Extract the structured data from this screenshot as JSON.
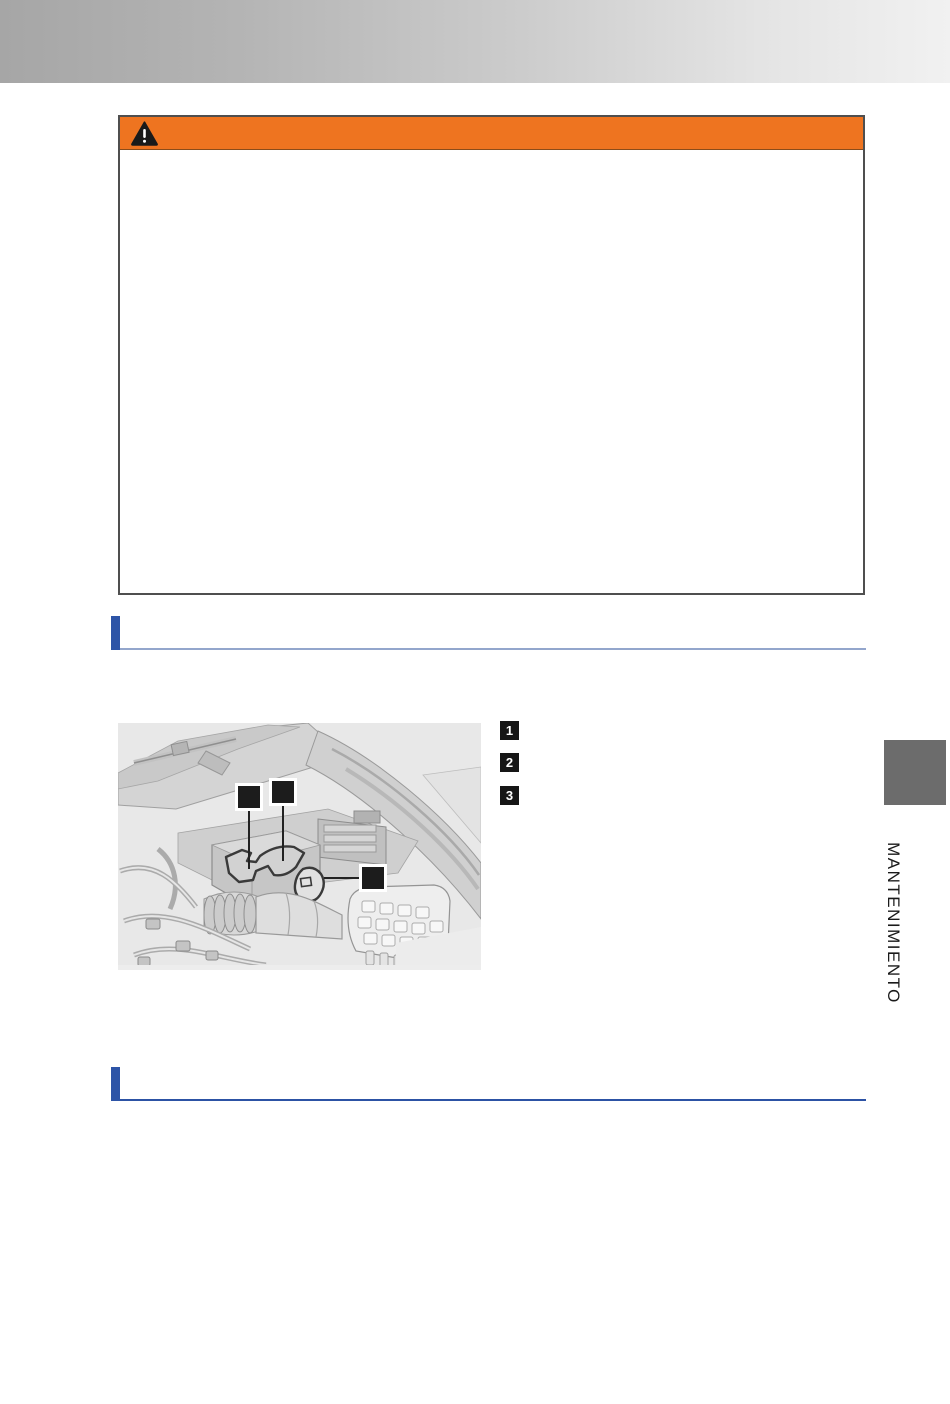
{
  "document": {
    "side_tab": {
      "label": "MANTENIMIENTO"
    }
  },
  "warning_box": {
    "icon": "warning-triangle-icon",
    "header_color": "#ee7420",
    "border_color": "#4f4f4f"
  },
  "figure": {
    "alt": "Engine compartment illustration with three black callout markers",
    "background": "#e8e8e8",
    "callout_color": "#1c1c1c"
  },
  "legend": {
    "items": [
      {
        "number": "1"
      },
      {
        "number": "2"
      },
      {
        "number": "3"
      }
    ]
  },
  "colors": {
    "accent_orange": "#ee7420",
    "accent_blue": "#2d54a7",
    "rule_light_blue": "#93a6cc",
    "tab_gray": "#6c6c6c",
    "header_gradient_left": "#a6a6a6",
    "header_gradient_right": "#f1f1f1"
  }
}
